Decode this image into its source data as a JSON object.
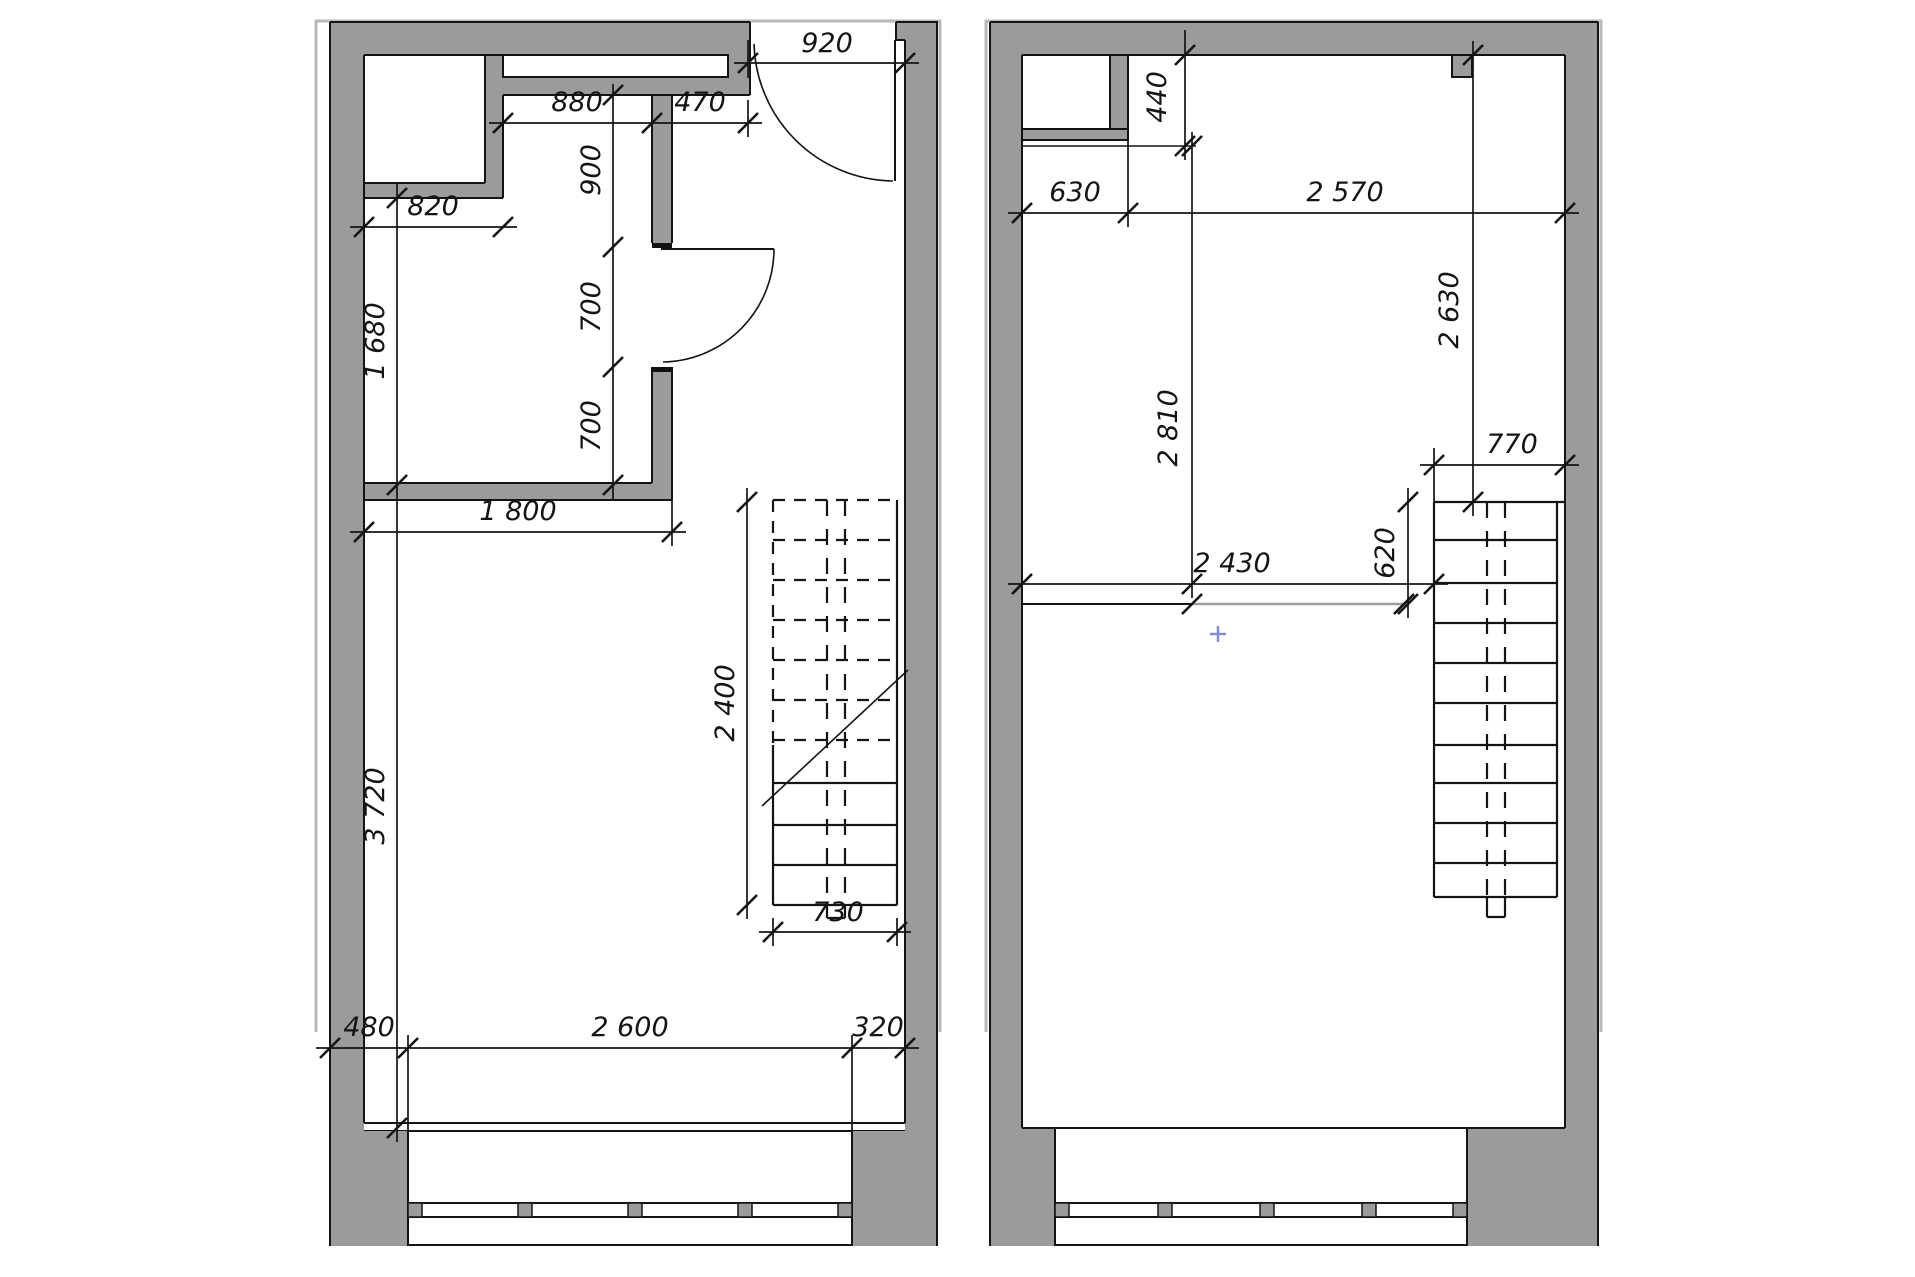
{
  "drawing": {
    "type": "architectural-floor-plan",
    "units": "mm",
    "colors": {
      "wall_fill": "#9b9b9b",
      "line": "#141414",
      "outer_boundary": "#b9b9b9",
      "mezzanine_edge": "#9f9f9f",
      "cursor": "#8090d8",
      "background": "#ffffff"
    },
    "cursor": {
      "symbol": "+",
      "x": 1218,
      "y": 634
    }
  },
  "plans": {
    "left": {
      "name": "lower-level-floor-plan",
      "dims": {
        "d920": "920",
        "d880": "880",
        "d470": "470",
        "d900": "900",
        "d700a": "700",
        "d700b": "700",
        "d820": "820",
        "d1680": "1 680",
        "d1800": "1 800",
        "d2400": "2 400",
        "d730": "730",
        "d3720": "3 720",
        "d480": "480",
        "d2600": "2 600",
        "d320": "320"
      }
    },
    "right": {
      "name": "upper-level-floor-plan",
      "dims": {
        "d440": "440",
        "d630": "630",
        "d2570": "2 570",
        "d2810": "2 810",
        "d2630": "2 630",
        "d770": "770",
        "d620": "620",
        "d2430": "2 430"
      }
    }
  }
}
